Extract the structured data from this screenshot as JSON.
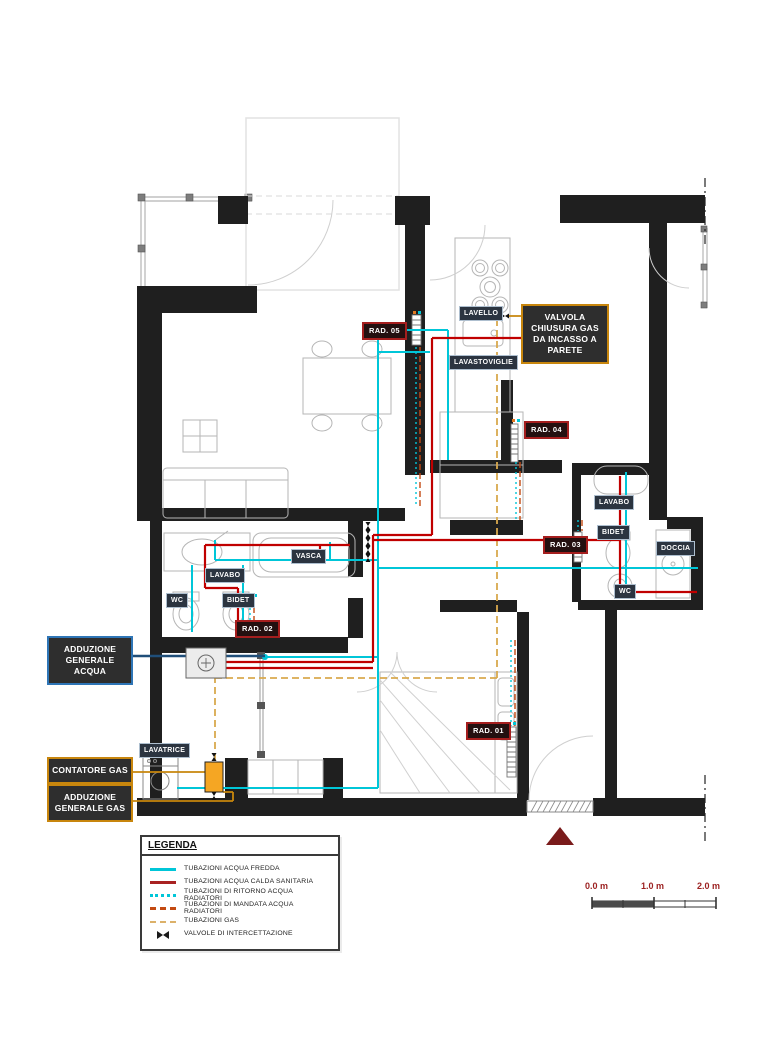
{
  "plan": {
    "fixture_labels": {
      "rad05": "RAD. 05",
      "lavello": "LAVELLO",
      "lavastoviglie": "LAVASTOVIGLIE",
      "rad04": "RAD. 04",
      "lavabo_dx": "LAVABO",
      "bidet_dx": "BIDET",
      "rad03": "RAD. 03",
      "doccia": "DOCCIA",
      "wc_dx": "WC",
      "vasca": "VASCA",
      "lavabo_sx": "LAVABO",
      "wc_sx": "WC",
      "bidet_sx": "BIDET",
      "rad02": "RAD. 02",
      "rad01": "RAD. 01",
      "lavatrice": "LAVATRICE"
    },
    "callouts": {
      "valvola_gas": "VALVOLA CHIUSURA GAS DA INCASSO A PARETE",
      "adduzione_acqua": "ADDUZIONE GENERALE ACQUA",
      "contatore_gas": "CONTATORE GAS",
      "adduzione_gas": "ADDUZIONE GENERALE GAS"
    }
  },
  "legend": {
    "title": "LEGENDA",
    "items": [
      {
        "label": "TUBAZIONI ACQUA FREDDA",
        "color": "#00c6d8",
        "style": "solid"
      },
      {
        "label": "TUBAZIONI ACQUA CALDA SANITARIA",
        "color": "#a82222",
        "style": "solid"
      },
      {
        "label": "TUBAZIONI DI RITORNO ACQUA RADIATORI",
        "color": "#00c6d8",
        "style": "dotted"
      },
      {
        "label": "TUBAZIONI DI MANDATA ACQUA RADIATORI",
        "color": "#c34a12",
        "style": "dashdot"
      },
      {
        "label": "TUBAZIONI GAS",
        "color": "#dcb169",
        "style": "dashed"
      },
      {
        "label": "VALVOLE DI INTERCETTAZIONE",
        "color": "#1a1a1a",
        "style": "valve"
      }
    ]
  },
  "scale_bar": {
    "labels": [
      "0.0 m",
      "1.0 m",
      "2.0 m"
    ]
  },
  "colors": {
    "cold_water": "#00c6d8",
    "hot_water": "#c00000",
    "radiator_supply": "#c34a12",
    "gas": "#d9a94e",
    "water_leader": "#1f4e79",
    "wall": "#1f1f1f",
    "callout_gold": "#c8860d",
    "callout_blue": "#2e75b6",
    "scale_text": "#9c2121",
    "entrance_marker": "#7a1b1b"
  }
}
